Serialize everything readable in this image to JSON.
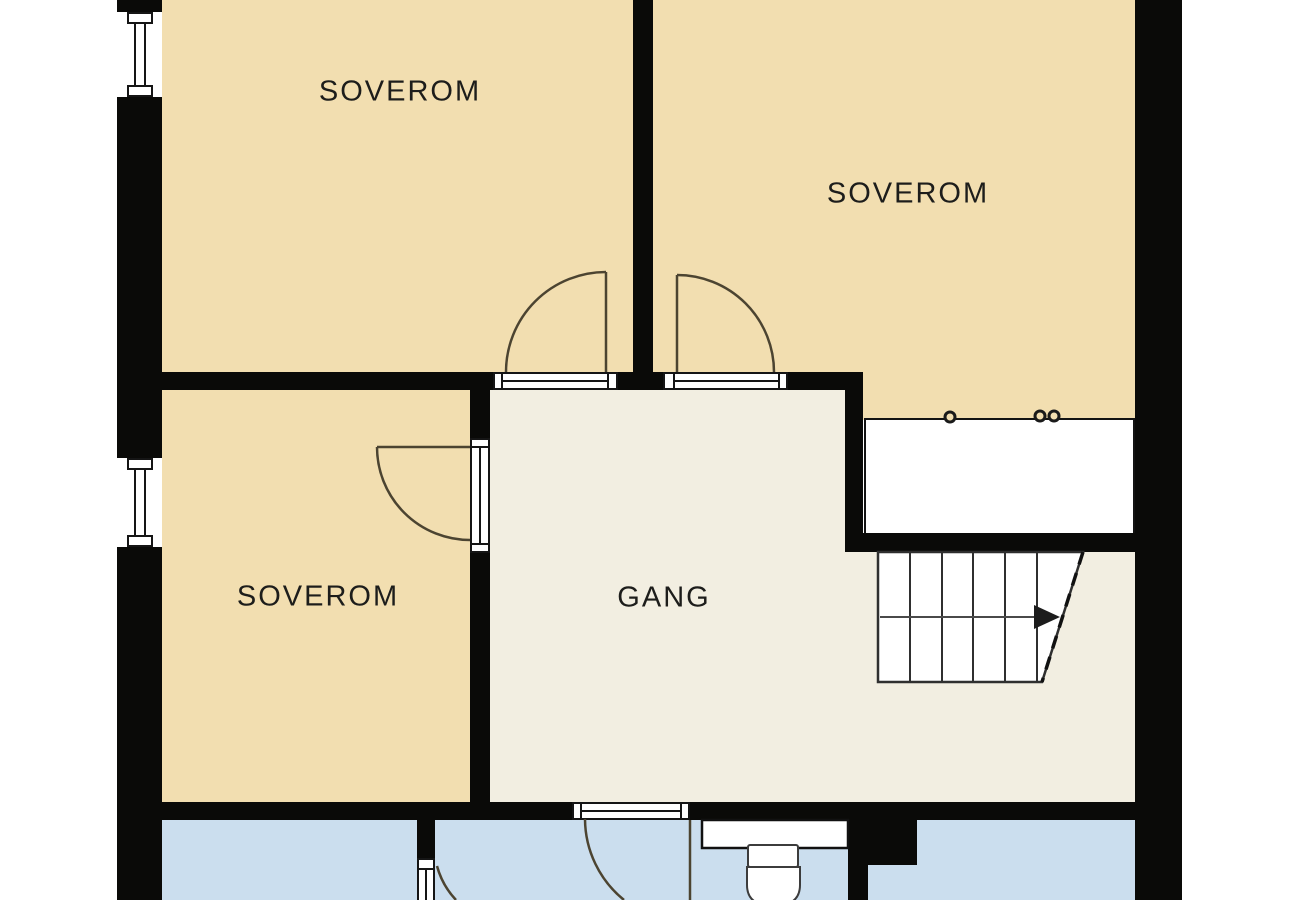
{
  "plan": {
    "rooms": [
      {
        "id": "soverom-top-left",
        "label": "SOVEROM"
      },
      {
        "id": "soverom-top-right",
        "label": "SOVEROM"
      },
      {
        "id": "soverom-mid-left",
        "label": "SOVEROM"
      },
      {
        "id": "gang",
        "label": "GANG"
      }
    ],
    "colors": {
      "bedroom": "#f2deb0",
      "hall": "#f2eee1",
      "bath": "#cbdeee",
      "wall": "#0a0a08",
      "outside": "#ffffff",
      "text": "#1d1d1b",
      "door": "#4c4431",
      "stair": "#2f2f2f",
      "fixture": "#3c3c3c"
    }
  }
}
